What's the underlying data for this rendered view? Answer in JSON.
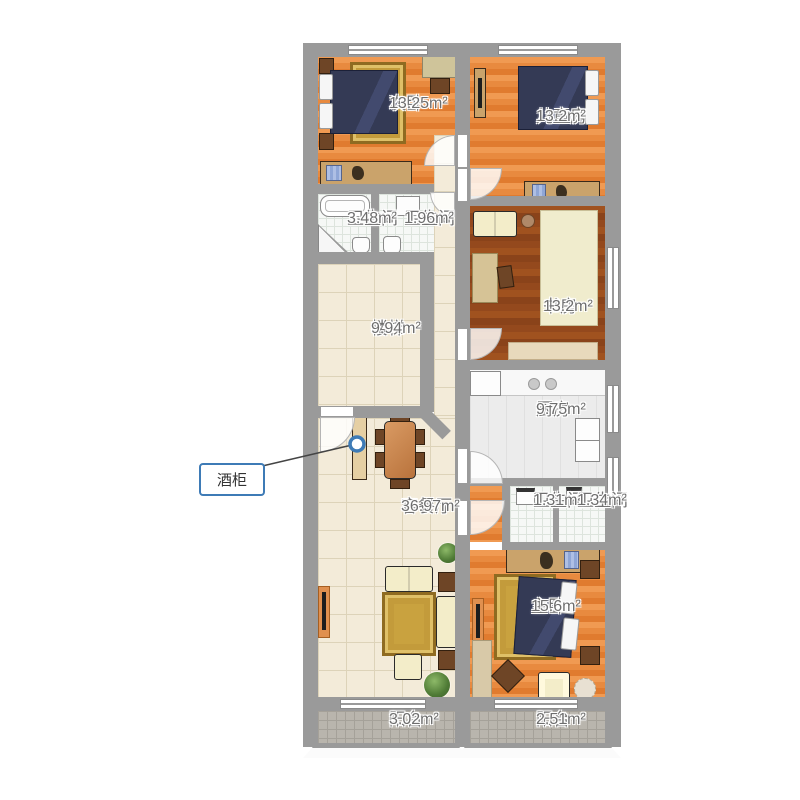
{
  "plan": {
    "title": "apartment-floor-plan",
    "rooms": [
      {
        "name": "次卧",
        "area": "13.25m²"
      },
      {
        "name": "儿童房",
        "area": "13.2m²"
      },
      {
        "name": "卫生间",
        "area": "3.48m²"
      },
      {
        "name": "卫生间",
        "area": "1.96m²"
      },
      {
        "name": "楼梯",
        "area": "9.94m²"
      },
      {
        "name": "书房",
        "area": "13.2m²"
      },
      {
        "name": "厨房",
        "area": "9.75m²"
      },
      {
        "name": "客餐厅",
        "area": "36.97m²"
      },
      {
        "name": "卫生间",
        "area": "1.31m²"
      },
      {
        "name": "卫生间",
        "area": "1.34m²"
      },
      {
        "name": "主卧",
        "area": "15.6m²"
      },
      {
        "name": "阳台",
        "area": "3.02m²"
      },
      {
        "name": "阳台",
        "area": "2.51m²"
      }
    ],
    "callout": {
      "label": "酒柜"
    },
    "colors": {
      "wall": "#9a9a9a",
      "wood_floor": "#e8883e",
      "dark_wood_floor": "#94491d",
      "tile_floor": "#f3ebd9",
      "bathroom_tile": "#f6f8f6",
      "balcony_tile": "#b9b5ad",
      "kitchen_floor": "#ececec",
      "bed": "#343a55",
      "rug_gold": "#c9a23f",
      "sofa_cream": "#f3edc9",
      "furniture_tan": "#caa36b",
      "callout_accent": "#3e7bb6"
    }
  }
}
